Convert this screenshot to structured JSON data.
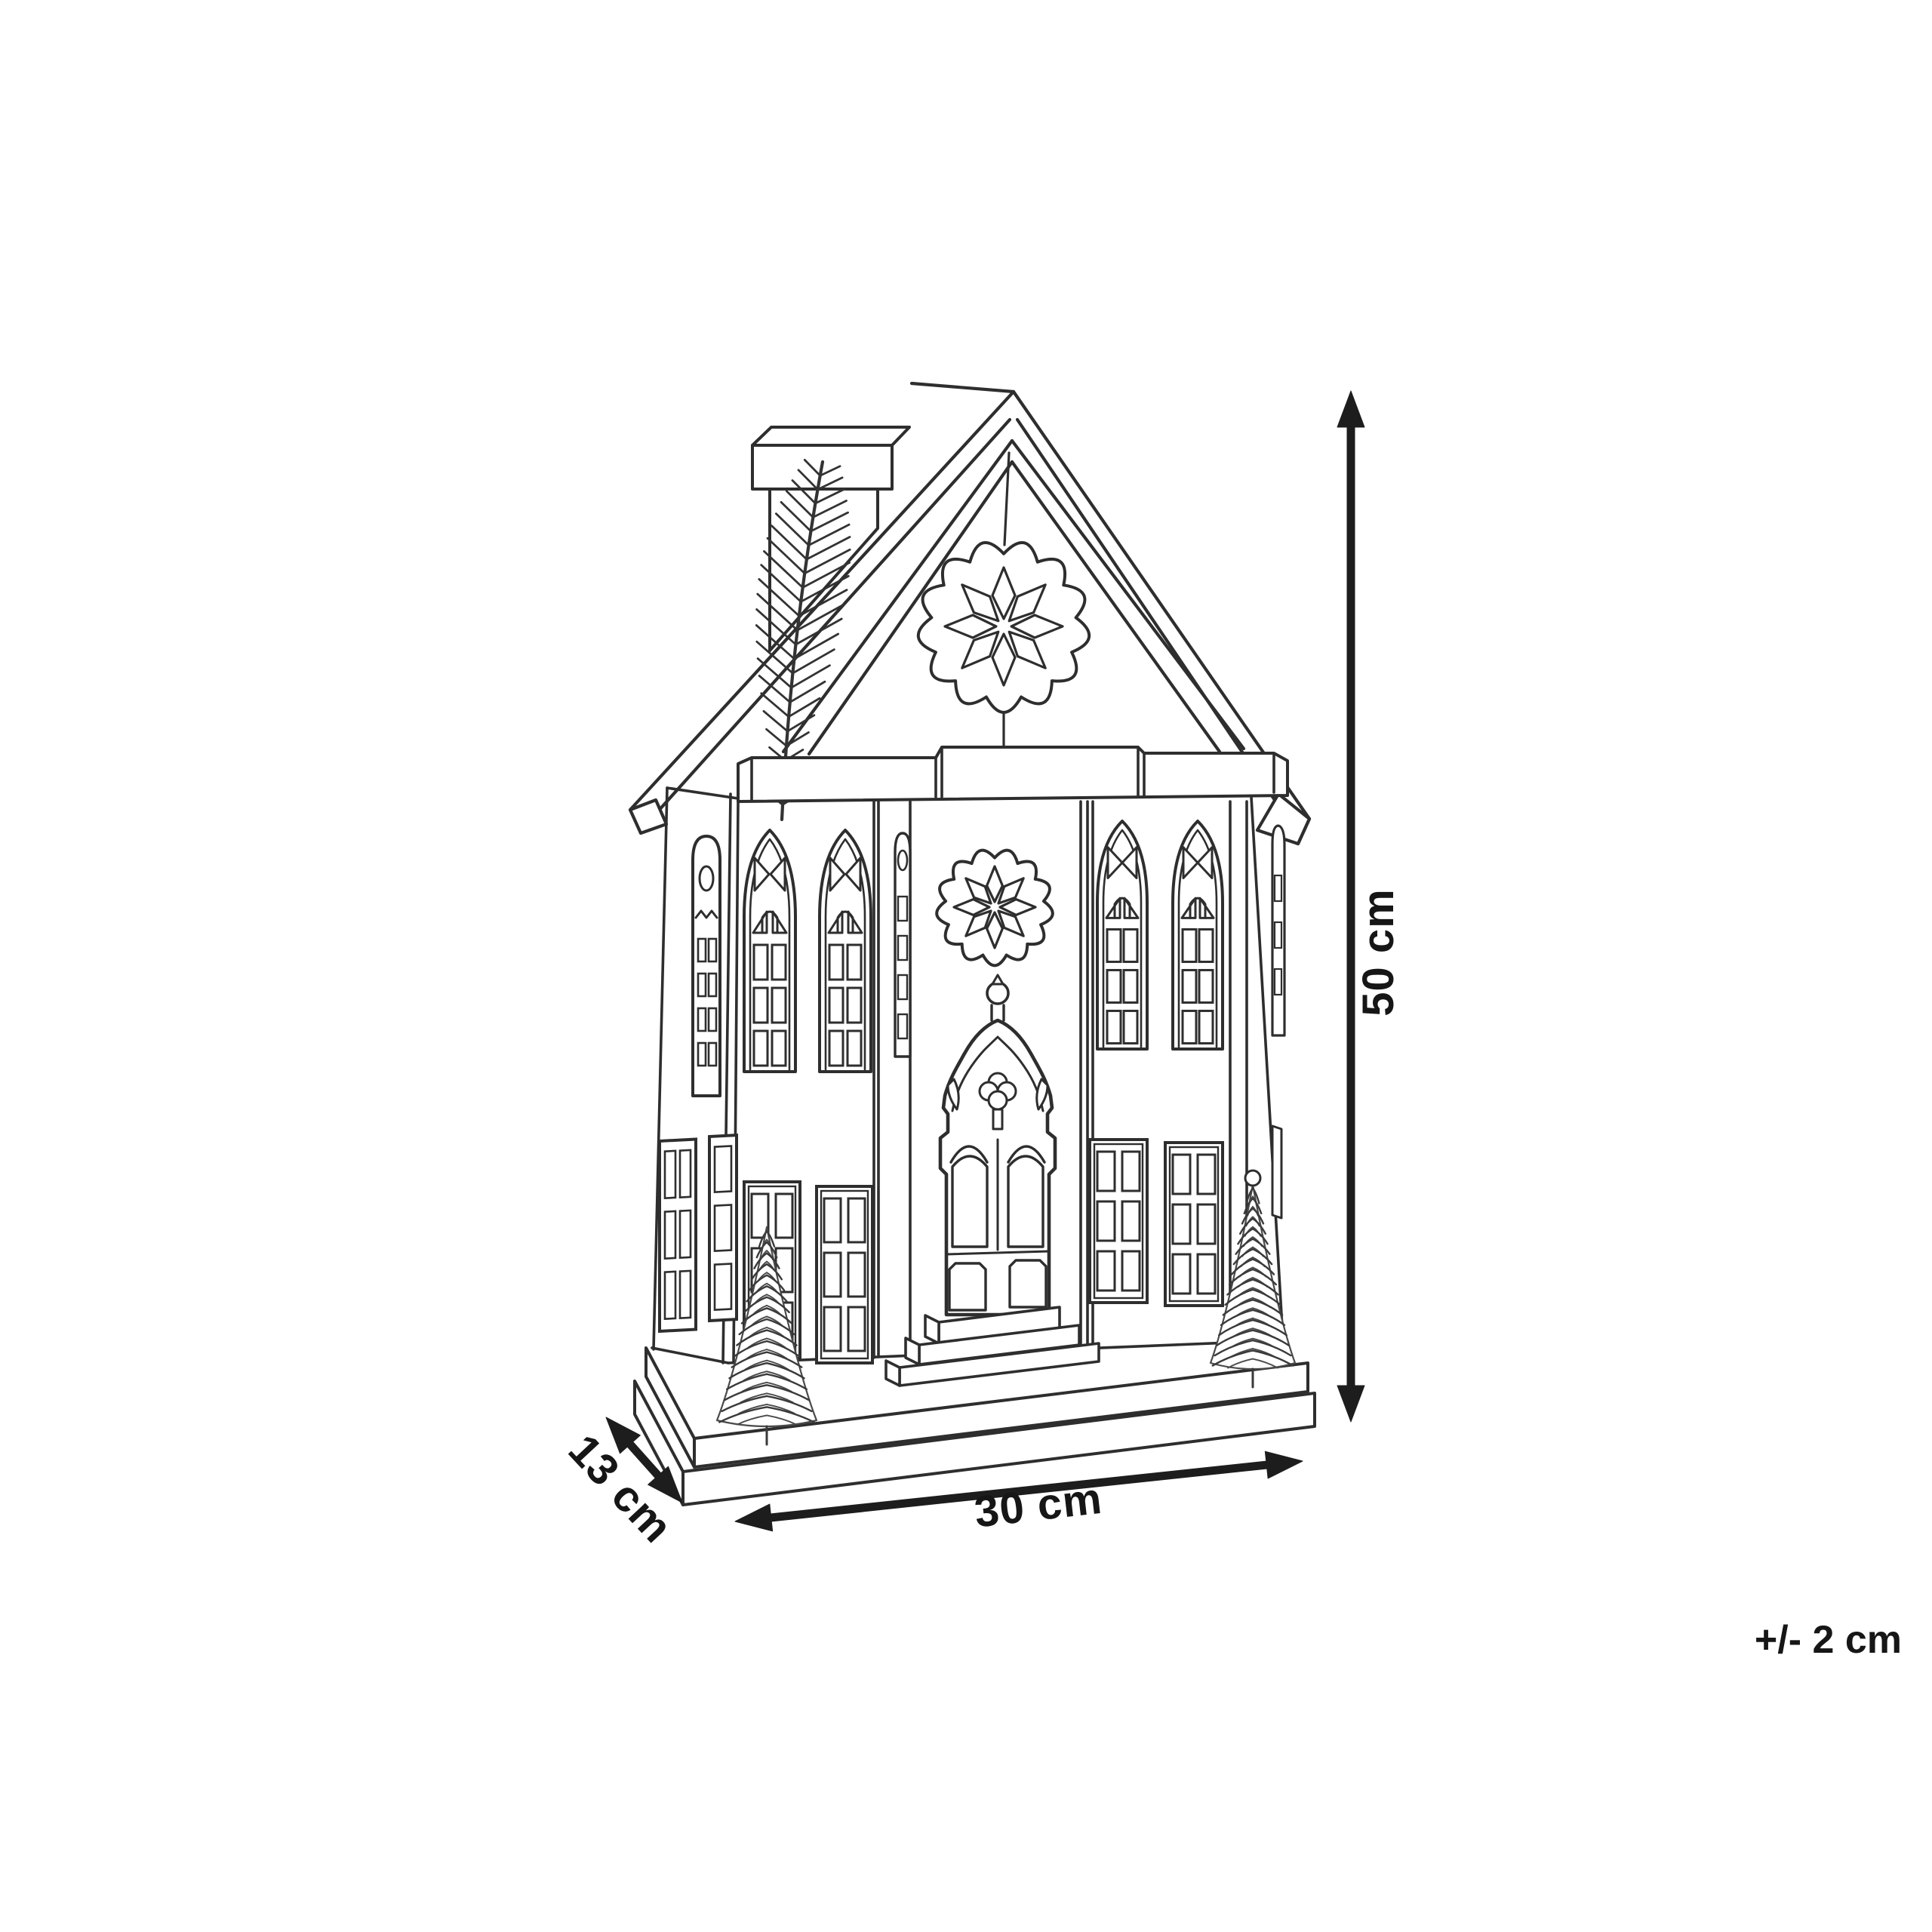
{
  "diagram": {
    "dimension_labels": {
      "height": "50 cm",
      "width": "30 cm",
      "depth": "13 cm",
      "tolerance": "+/- 2 cm"
    },
    "style": {
      "line_color": "#2e2e2e",
      "dimension_color": "#1d1d1d",
      "background": "#ffffff"
    }
  }
}
